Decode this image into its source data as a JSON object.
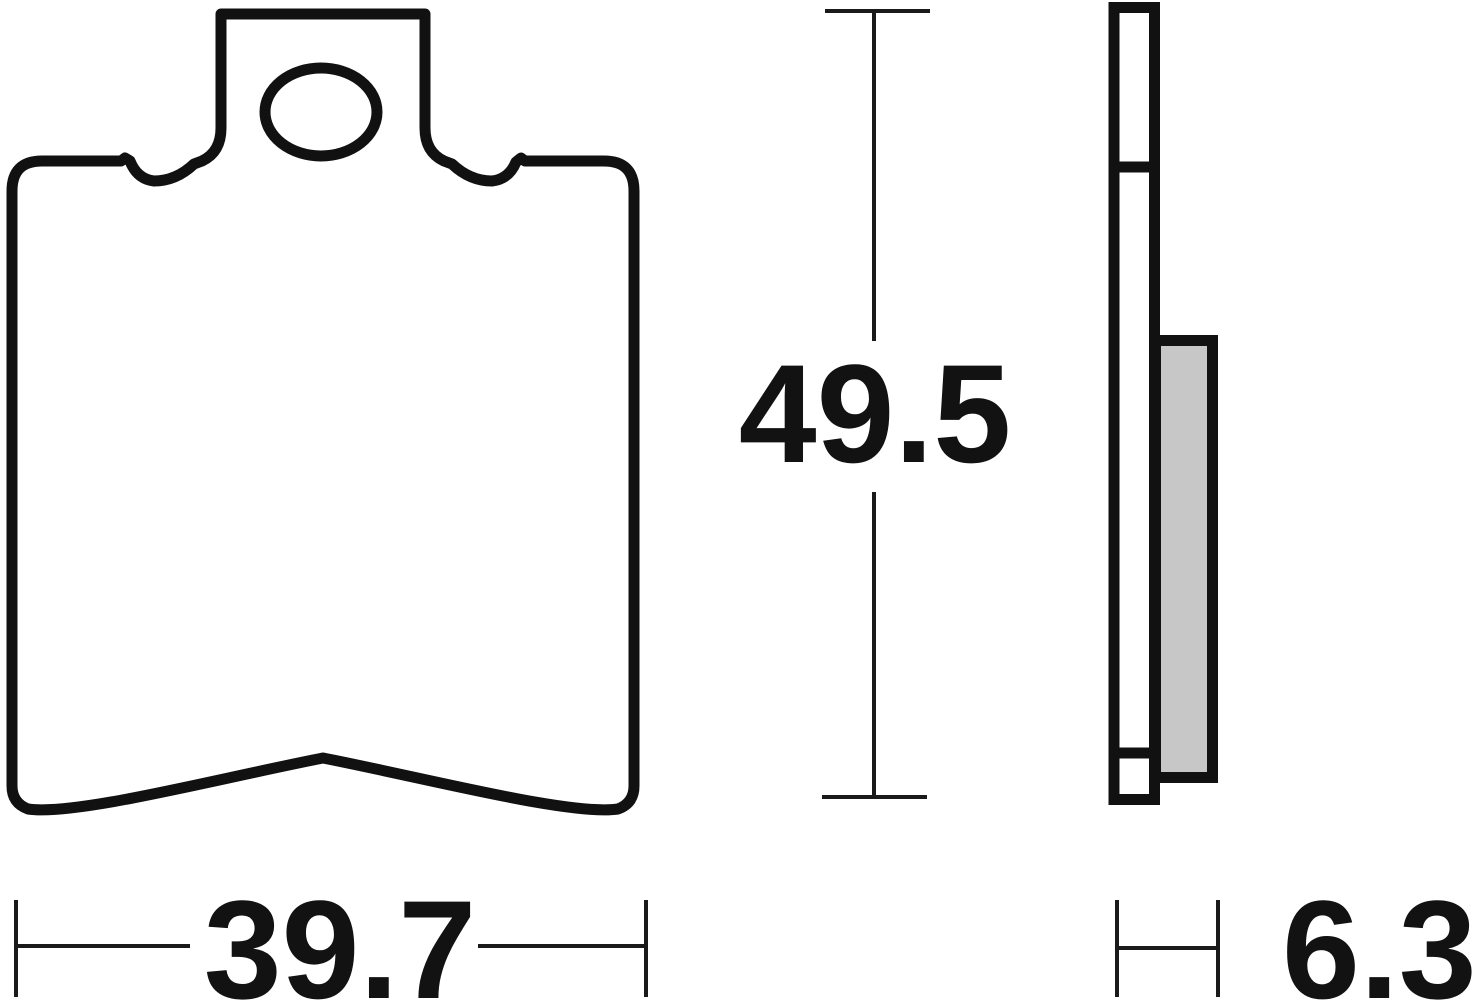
{
  "drawing": {
    "kind": "brake-pad-technical-drawing",
    "dimensions": {
      "height": {
        "value": "49.5"
      },
      "width": {
        "value": "39.7"
      },
      "thickness": {
        "value": "6.3"
      }
    },
    "colors": {
      "outline": "#111111",
      "friction_material": "#c7c7c7",
      "background": "#ffffff"
    }
  }
}
